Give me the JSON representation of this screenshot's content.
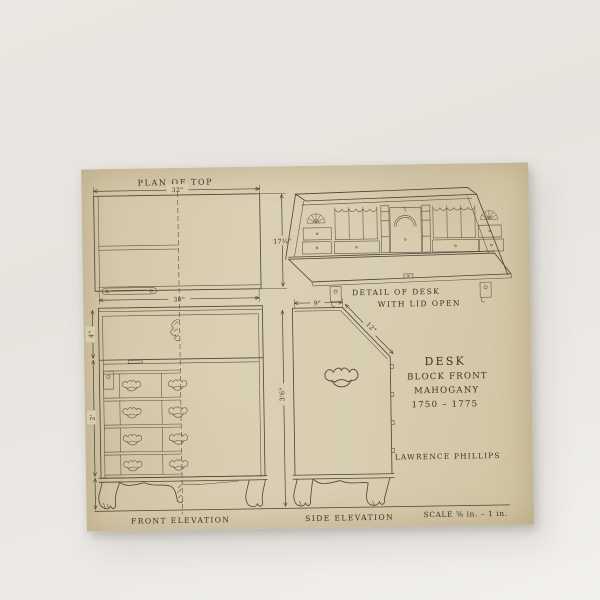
{
  "scene": {
    "background_color": "#e9e5e0",
    "paper_color": "#d8cdb0",
    "ink_color": "#4d4336"
  },
  "plan": {
    "title": "PLAN OF TOP",
    "dim_width_top": "32\"",
    "dim_depth": "17¾\"",
    "dim_width_bottom": "30\""
  },
  "detail": {
    "caption_line1": "DETAIL OF DESK",
    "caption_line2": "WITH LID OPEN"
  },
  "front_elevation": {
    "caption": "FRONT ELEVATION",
    "dim_lid_section": "4\"",
    "dim_drawer_section": "2'"
  },
  "side_elevation": {
    "caption": "SIDE ELEVATION",
    "dim_top_depth": "9\"",
    "dim_lid_slant": "12\"",
    "dim_height": "3'6\""
  },
  "title_block": {
    "line1": "DESK",
    "line2": "BLOCK FRONT",
    "line3": "MAHOGANY",
    "line4": "1750 – 1775",
    "artist": "LAWRENCE PHILLIPS"
  },
  "scale_note": "SCALE ⅜ in. – 1 in."
}
